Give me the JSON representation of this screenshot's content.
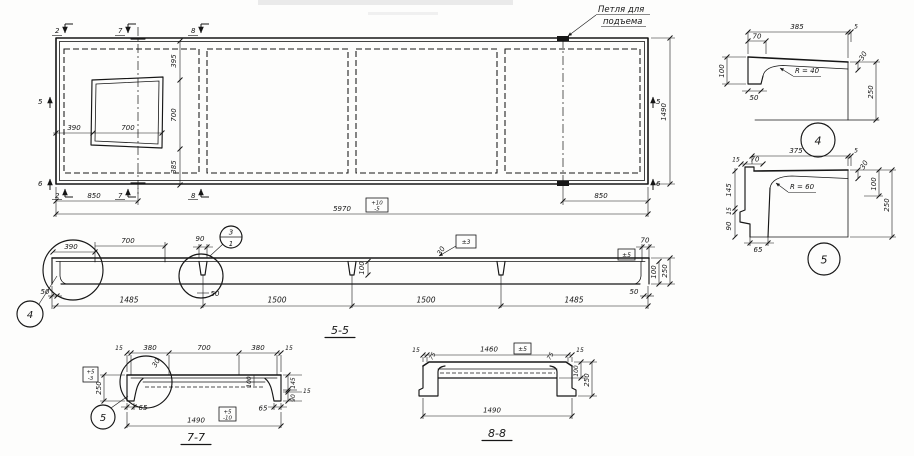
{
  "plan": {
    "loop_note_line1": "Петля для",
    "loop_note_line2": "подъема",
    "marks": {
      "top2": "2",
      "top7": "7",
      "top8": "8",
      "bot2": "2",
      "bot7": "7",
      "bot8": "8",
      "left5": "5",
      "left6": "6",
      "right5": "5",
      "right6": "6"
    },
    "dims": {
      "d390": "390",
      "d700h": "700",
      "d395": "395",
      "d700v": "700",
      "d385": "385",
      "d850l": "850",
      "d850r": "850",
      "d5970": "5970",
      "d1490": "1490"
    },
    "tol": {
      "plus10": "+10",
      "minus5": "-5"
    }
  },
  "section55": {
    "title": "5-5",
    "dims": {
      "d390": "390",
      "d700": "700",
      "d90": "90",
      "d50l": "50",
      "d50m": "50",
      "d50r": "50",
      "span1": "1485",
      "span2": "1500",
      "span3": "1500",
      "span4": "1485",
      "d30": "30",
      "d100m": "100",
      "d70": "70",
      "d100r": "100",
      "d250": "250"
    },
    "tol": {
      "pm3": "±3",
      "pm5": "±5"
    },
    "callouts": {
      "top": "3",
      "bottom": "1",
      "detail": "4"
    }
  },
  "detail4": {
    "number": "4",
    "radius": "R = 40",
    "dims": {
      "d385": "385",
      "d5": "5",
      "d70": "70",
      "d100": "100",
      "d50": "50",
      "d30": "30",
      "d250": "250"
    }
  },
  "detail5": {
    "number": "5",
    "radius": "R = 60",
    "dims": {
      "d375": "375",
      "d5": "5",
      "d15t": "15",
      "d70": "70",
      "d145": "145",
      "d15l": "15",
      "d90": "90",
      "d65": "65",
      "d30": "30",
      "d100": "100",
      "d250": "250"
    }
  },
  "section77": {
    "title": "7-7",
    "callout": "5",
    "dims": {
      "d15l": "15",
      "d380l": "380",
      "d700": "700",
      "d380r": "380",
      "d15r": "15",
      "d30": "30",
      "d250": "250",
      "d65l": "65",
      "d65r": "65",
      "d100": "100",
      "d145": "145",
      "d15c": "15",
      "d90": "90",
      "d1490": "1490"
    },
    "tol": {
      "plus5": "+5",
      "minus3": "-3",
      "plus5b": "+5",
      "minus10": "-10"
    }
  },
  "section88": {
    "title": "8-8",
    "dims": {
      "d15l": "15",
      "d1460": "1460",
      "d15r": "15",
      "d75l": "75",
      "d75r": "75",
      "d100": "100",
      "d250": "250",
      "d1490": "1490"
    },
    "tol": {
      "pm5": "±5"
    }
  }
}
